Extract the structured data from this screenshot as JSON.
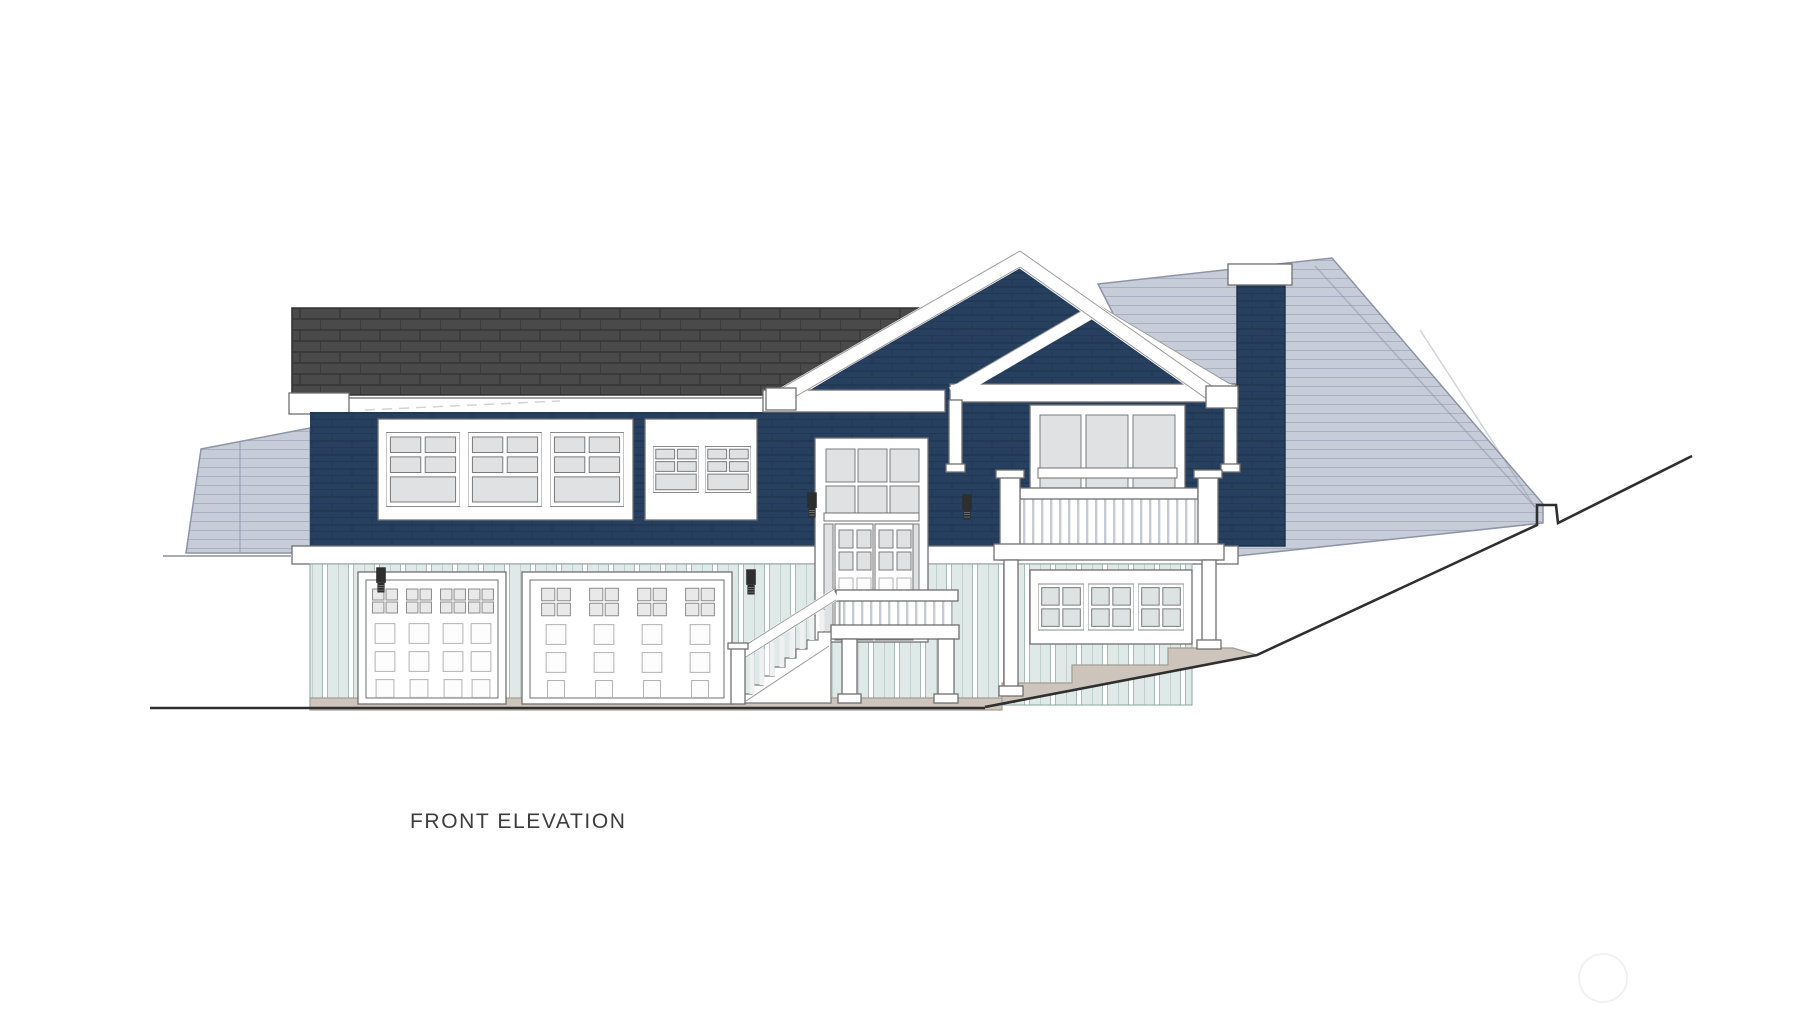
{
  "drawing": {
    "title": "FRONT ELEVATION"
  },
  "colors": {
    "navy": "#27405f",
    "navy_line": "#1b3049",
    "roof_dark": "#4a4a4a",
    "roof_dark_line": "#353535",
    "rear_roof": "#c7ccd9",
    "rear_roof_line": "#a9b0c2",
    "rear_roof_edge": "#8d94a6",
    "mint": "#dfe9e7",
    "mint_line": "#a7bab7",
    "trim_edge": "#6f6f6f",
    "glass": "#dfe1e3",
    "glass_lower": "#dce3e2",
    "garage_glass": "#e9e9e9",
    "panel_edge": "#b2b2b2",
    "concrete": "#cdc5bb",
    "concrete_edge": "#a39c91",
    "baluster_gap": "#c6cbd1",
    "sconce": "#2e2e2e",
    "ground": "#2f2f2f",
    "grade_light": "#a8adb6",
    "text": "#3c3c3c",
    "watermark": "#f1f1f1"
  }
}
